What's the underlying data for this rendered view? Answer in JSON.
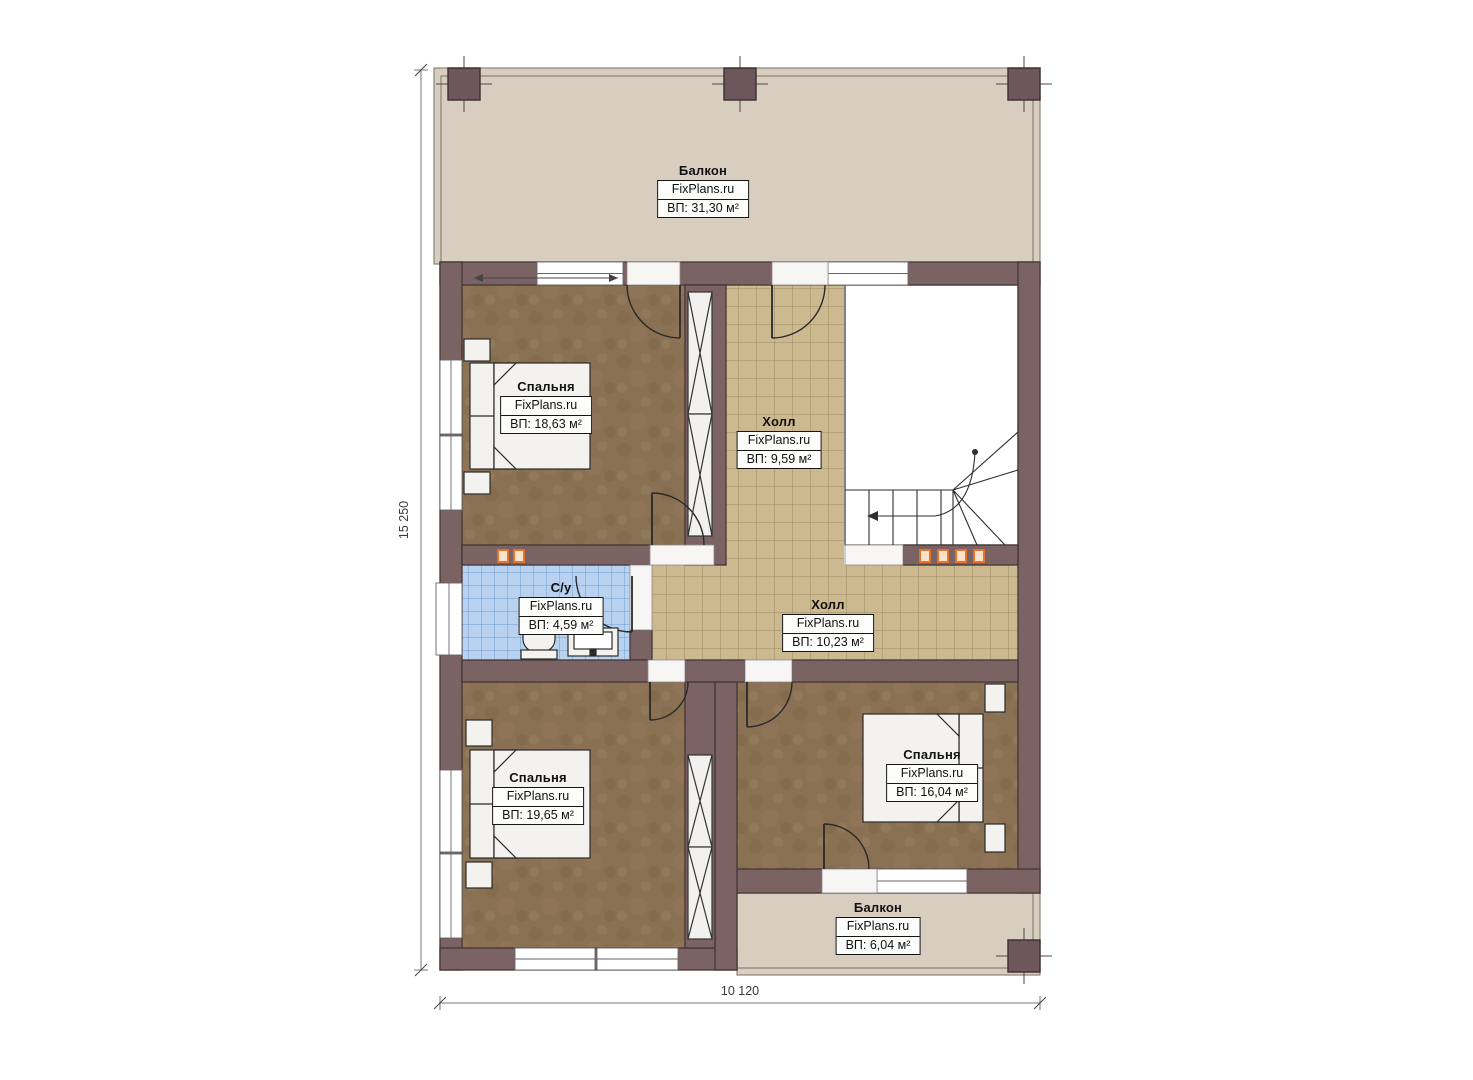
{
  "dimension_labels": {
    "vertical": "15 250",
    "horizontal": "10 120"
  },
  "rooms": [
    {
      "id": "balcony-top",
      "name": "Балкон",
      "source": "FixPlans.ru",
      "area": "ВП: 31,30 м²"
    },
    {
      "id": "bedroom-top-left",
      "name": "Спальня",
      "source": "FixPlans.ru",
      "area": "ВП: 18,63 м²"
    },
    {
      "id": "hall-upper",
      "name": "Холл",
      "source": "FixPlans.ru",
      "area": "ВП: 9,59 м²"
    },
    {
      "id": "bathroom",
      "name": "С/у",
      "source": "FixPlans.ru",
      "area": "ВП: 4,59 м²"
    },
    {
      "id": "hall-lower",
      "name": "Холл",
      "source": "FixPlans.ru",
      "area": "ВП: 10,23 м²"
    },
    {
      "id": "bedroom-bottom-left",
      "name": "Спальня",
      "source": "FixPlans.ru",
      "area": "ВП: 19,65 м²"
    },
    {
      "id": "bedroom-bottom-right",
      "name": "Спальня",
      "source": "FixPlans.ru",
      "area": "ВП: 16,04 м²"
    },
    {
      "id": "balcony-bottom",
      "name": "Балкон",
      "source": "FixPlans.ru",
      "area": "ВП: 6,04 м²"
    }
  ],
  "colors": {
    "wall": "#7b6364",
    "wall_outline": "#443637",
    "carpet": "#8a7153",
    "hall_tile": "#cdb990",
    "bath_tile": "#b8d2ef",
    "balcony_floor": "#d8cec0",
    "accent_orange": "#e8732c"
  }
}
